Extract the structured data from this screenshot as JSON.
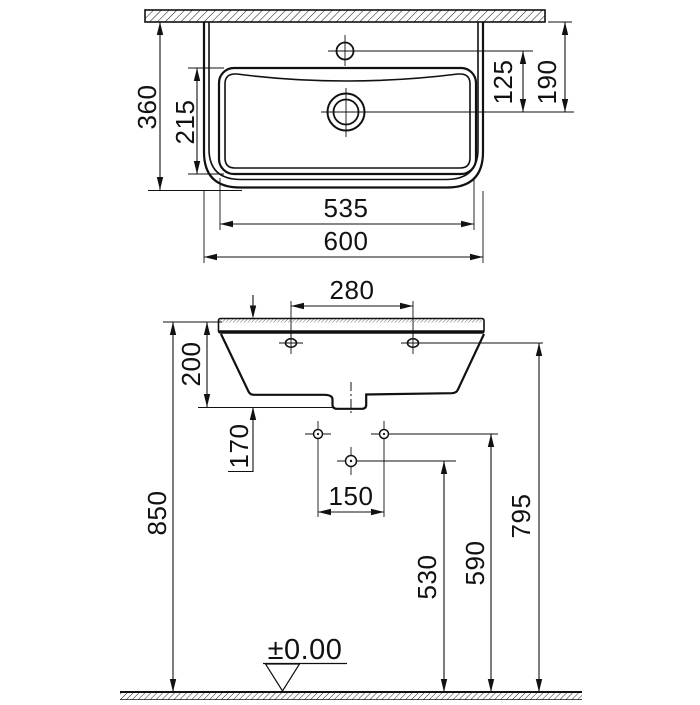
{
  "drawing": {
    "type": "washbasin installation dimension drawing",
    "background": "#ffffff",
    "line_color": "#111111",
    "top_view": {
      "dim_overall_depth": "360",
      "dim_bowl_depth": "215",
      "dim_tap_to_drain": "125",
      "dim_wall_to_drain": "190",
      "dim_bowl_width": "535",
      "dim_overall_width": "600"
    },
    "front_view": {
      "dim_fixing_hole_spacing": "280",
      "dim_front_apron_height": "200",
      "dim_outlet_offset": "170",
      "dim_supply_hole_spacing": "150",
      "dim_rim_height_from_floor": "850",
      "dim_drain_height": "530",
      "dim_supply_height": "590",
      "dim_fixing_hole_height": "795",
      "floor_level_label": "±0.00"
    }
  }
}
